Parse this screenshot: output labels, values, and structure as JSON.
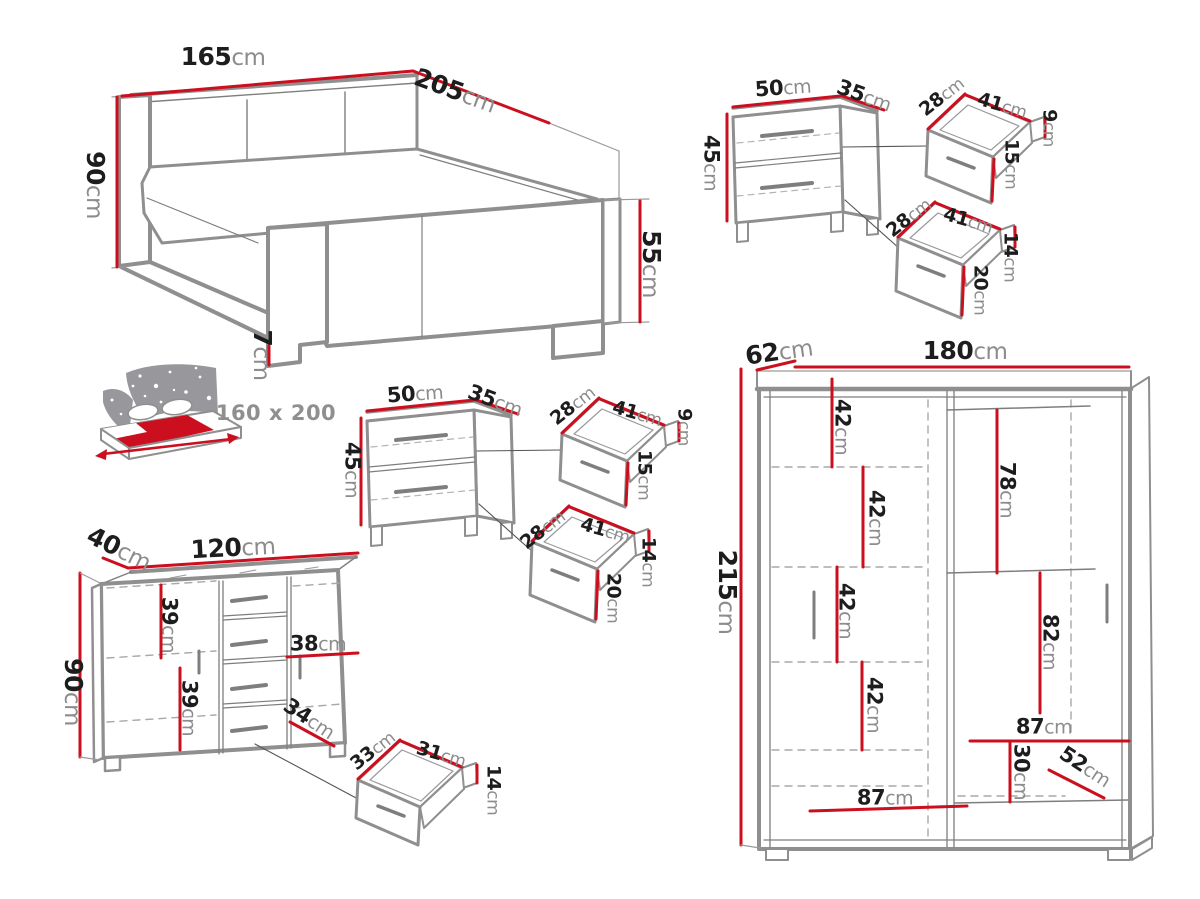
{
  "unit": "cm",
  "colors": {
    "accent": "#cc0f1e",
    "value_text": "#1d1d1d",
    "unit_text": "#8c8c8c",
    "outline_gray": "#8f8f8f"
  },
  "mattress_badge": "160 x 200",
  "bed": {
    "width": "165",
    "length": "205",
    "height": "90",
    "footboard_height": "55",
    "leg_height": "7"
  },
  "nightstand_a": {
    "width": "50",
    "depth": "35",
    "height": "45",
    "drawer_top": {
      "depth": "28",
      "width": "41",
      "back_height": "9",
      "front_height": "15"
    },
    "drawer_bottom": {
      "depth": "28",
      "width": "41",
      "back_height": "14",
      "front_height": "20"
    }
  },
  "nightstand_b": {
    "width": "50",
    "depth": "35",
    "height": "45",
    "drawer_top": {
      "depth": "28",
      "width": "41",
      "back_height": "9",
      "front_height": "15"
    },
    "drawer_bottom": {
      "depth": "28",
      "width": "41",
      "back_height": "14",
      "front_height": "20"
    }
  },
  "dresser": {
    "depth": "40",
    "width": "120",
    "height": "90",
    "shelf_gap_top": "39",
    "shelf_gap_bottom": "39",
    "inner_width": "38",
    "inner_depth": "34",
    "drawer": {
      "depth": "33",
      "width": "31",
      "height": "14"
    }
  },
  "wardrobe": {
    "depth": "62",
    "width": "180",
    "height": "215",
    "shelf_gaps": [
      "42",
      "42",
      "42",
      "42"
    ],
    "hang_top": "78",
    "hang_bottom": "82",
    "right_width": "87",
    "bottom_height": "30",
    "bottom_depth": "52",
    "left_width": "87"
  }
}
